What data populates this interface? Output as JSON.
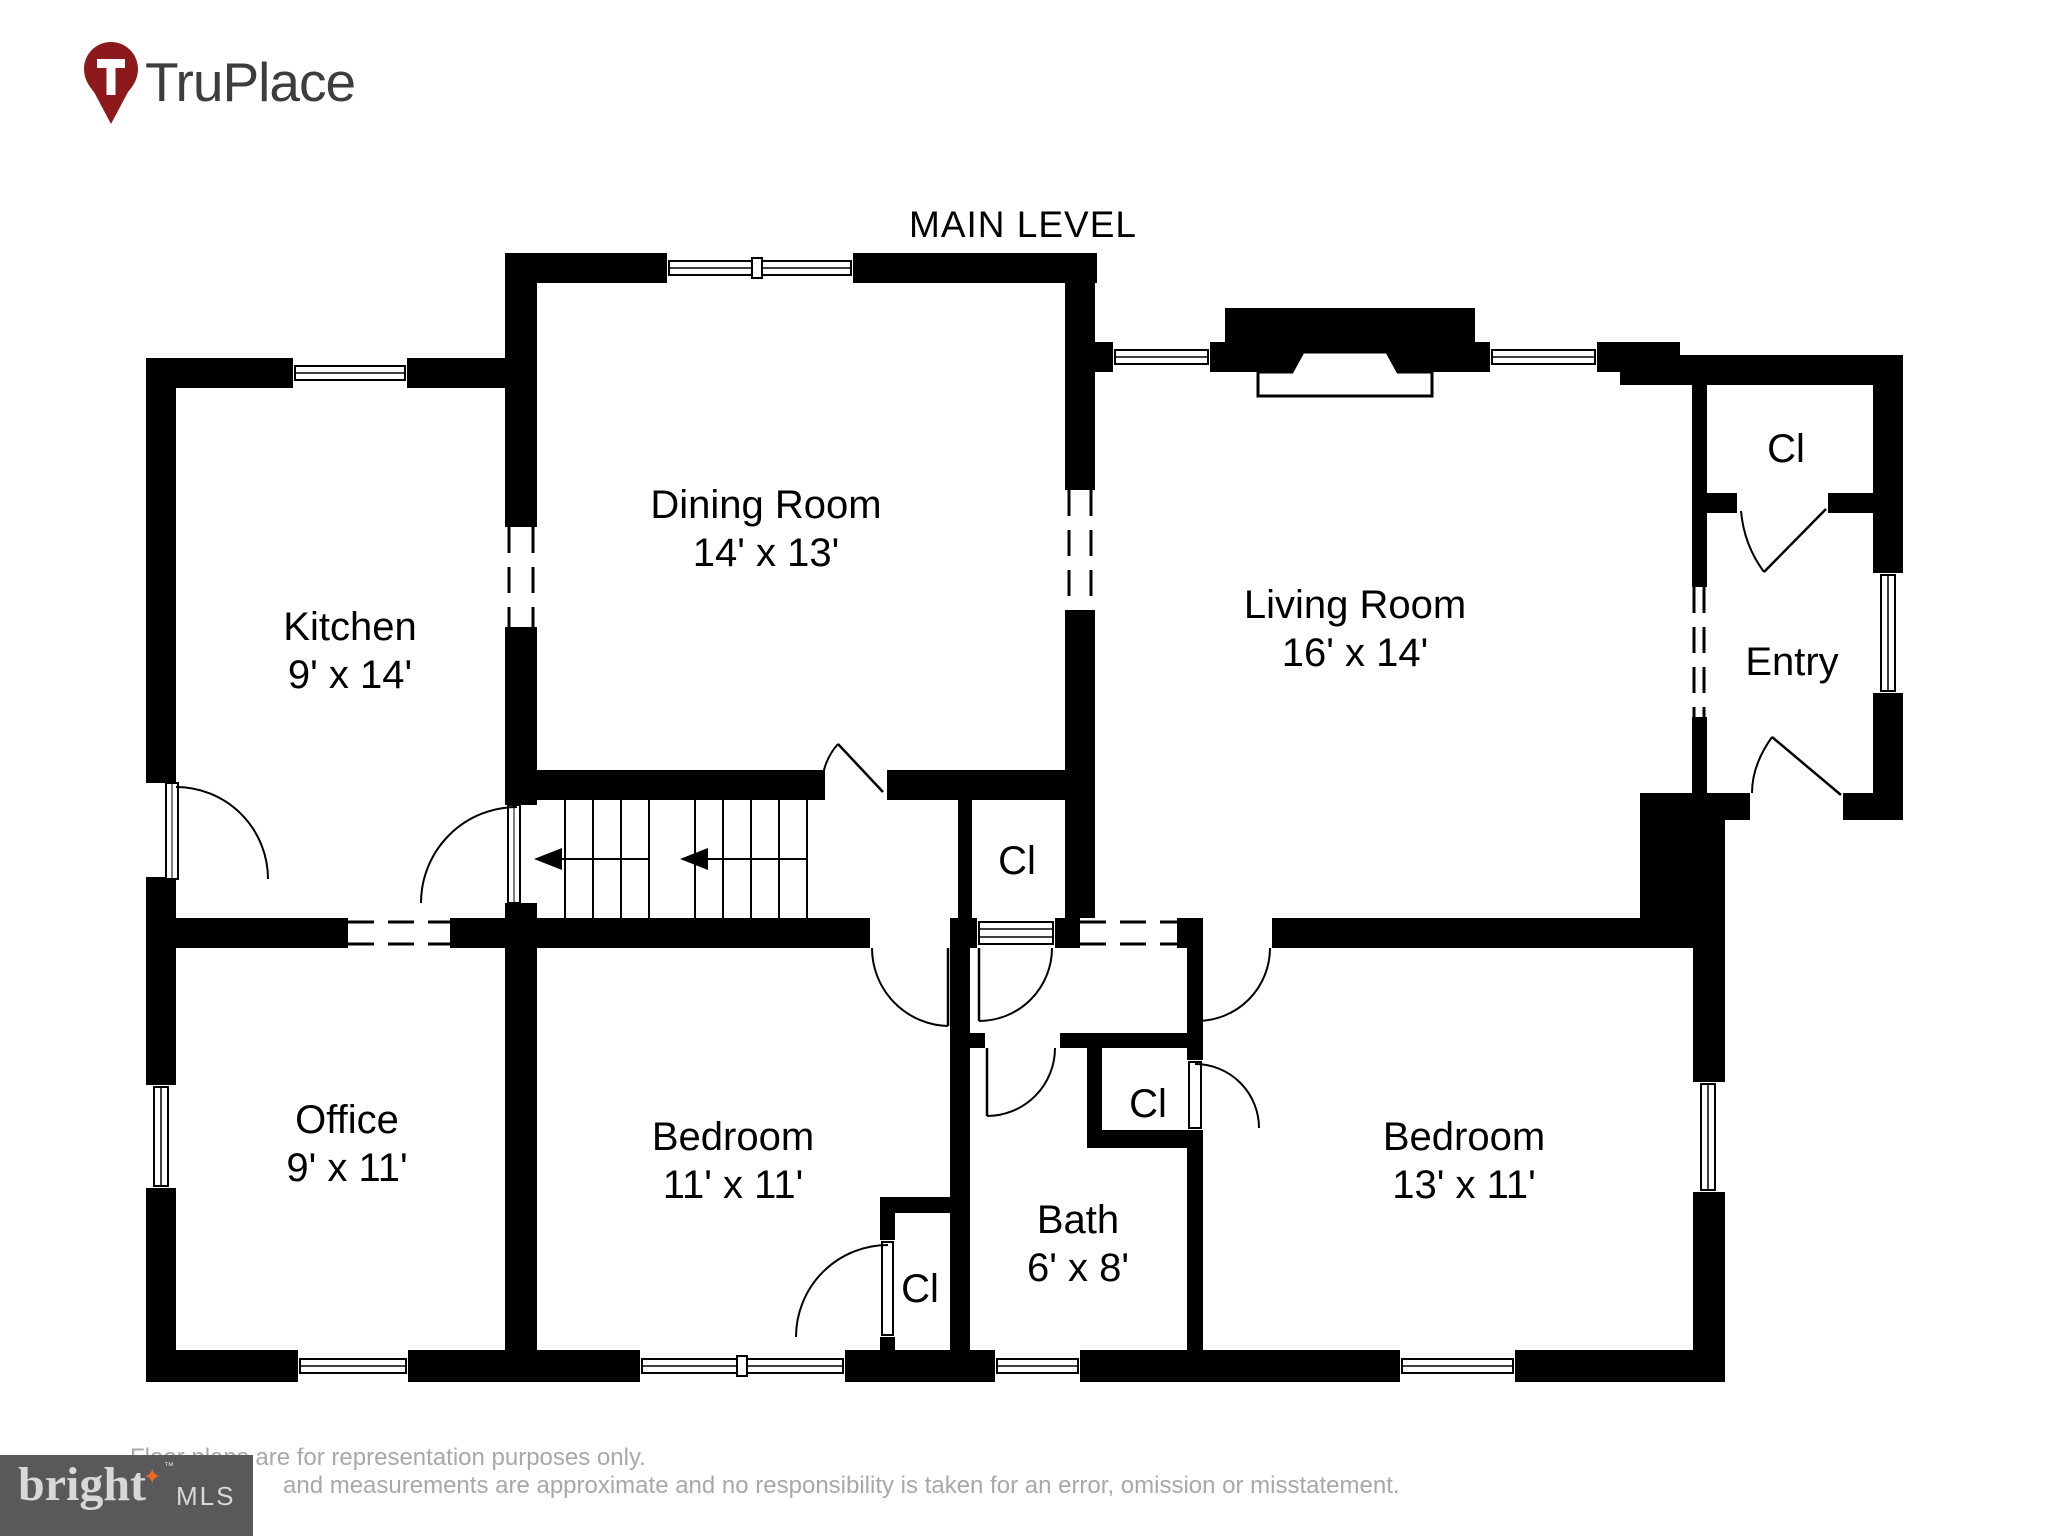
{
  "branding": {
    "name": "TruPlace"
  },
  "plan": {
    "title": "MAIN LEVEL"
  },
  "rooms": {
    "kitchen": {
      "name": "Kitchen",
      "dims": "9' x 14'"
    },
    "dining_room": {
      "name": "Dining Room",
      "dims": "14' x 13'"
    },
    "living_room": {
      "name": "Living Room",
      "dims": "16' x 14'"
    },
    "entry": {
      "name": "Entry"
    },
    "office": {
      "name": "Office",
      "dims": "9' x 11'"
    },
    "bedroom_left": {
      "name": "Bedroom",
      "dims": "11' x 11'"
    },
    "bath": {
      "name": "Bath",
      "dims": "6' x 8'"
    },
    "bedroom_right": {
      "name": "Bedroom",
      "dims": "13' x 11'"
    },
    "closet": {
      "abbr": "Cl"
    }
  },
  "footer": {
    "logo": {
      "brand": "bright",
      "suffix": "MLS",
      "trademark": "™",
      "star_icon": "four-pointed-star"
    },
    "disclaimer_line1": "Floor plans are for representation purposes only.",
    "disclaimer_line2": "and measurements are approximate and no responsibility is taken for an error, omission or misstatement."
  },
  "colors": {
    "wall_black": "#000000",
    "pin_red": "#8e191c",
    "logo_box_gray": "#58595b",
    "logo_text_gray": "#d7d8d9",
    "star_orange": "#f26722",
    "disclaimer_gray": "#a8a8a8"
  }
}
